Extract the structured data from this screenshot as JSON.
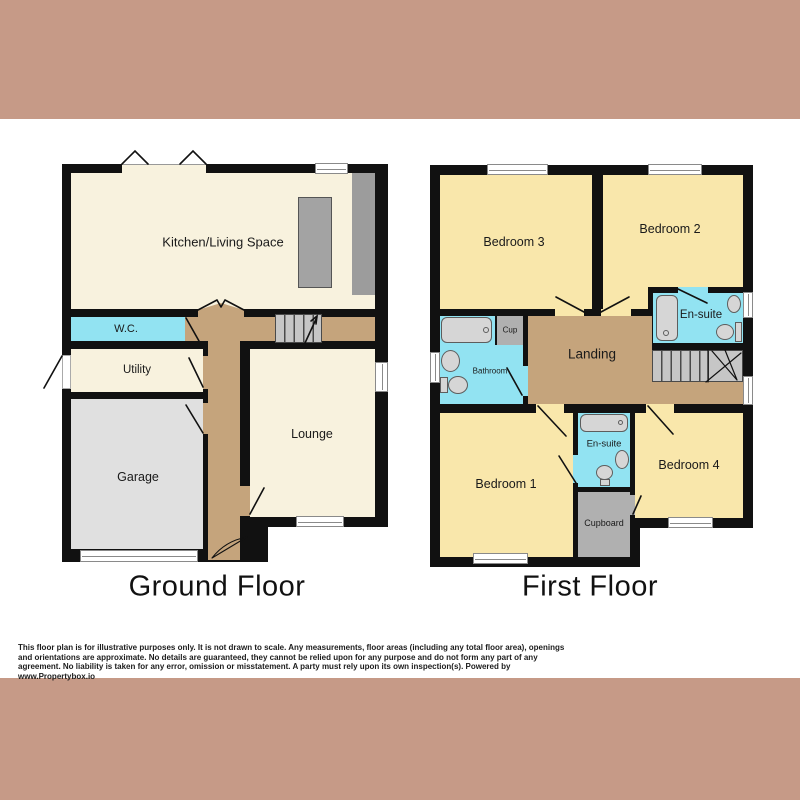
{
  "colors": {
    "band": "#c69a87",
    "background": "#ffffff",
    "wall": "#111111",
    "room_cream": "#f8f2de",
    "room_yellow": "#f9e7ab",
    "room_cyan": "#92e3f2",
    "hall_tan": "#c5a47c",
    "garage_gray": "#e0e0e0",
    "cupboard_gray": "#b0b0b0",
    "stairs_gray": "#c6c6c6",
    "counter_gray": "#9c9c9c"
  },
  "ground_floor": {
    "title": "Ground Floor",
    "rooms": {
      "kitchen": "Kitchen/Living Space",
      "wc": "W.C.",
      "utility": "Utility",
      "garage": "Garage",
      "lounge": "Lounge"
    }
  },
  "first_floor": {
    "title": "First Floor",
    "rooms": {
      "bedroom3": "Bedroom 3",
      "bedroom2": "Bedroom 2",
      "ensuite_top": "En-suite",
      "bathroom": "Bathroom",
      "cup": "Cup",
      "landing": "Landing",
      "bedroom1": "Bedroom 1",
      "ensuite_bottom": "En-suite",
      "bedroom4": "Bedroom 4",
      "cupboard": "Cupboard"
    }
  },
  "footer": {
    "disclaimer": "This floor plan is for illustrative purposes only. It is not drawn to scale. Any measurements, floor areas (including any total floor area), openings and orientations are approximate. No details are guaranteed, they cannot be relied upon for any purpose and do not form any part of any agreement. No liability is taken for any error, omission or misstatement. A party must rely upon its own inspection(s). Powered by www.Propertybox.io"
  }
}
